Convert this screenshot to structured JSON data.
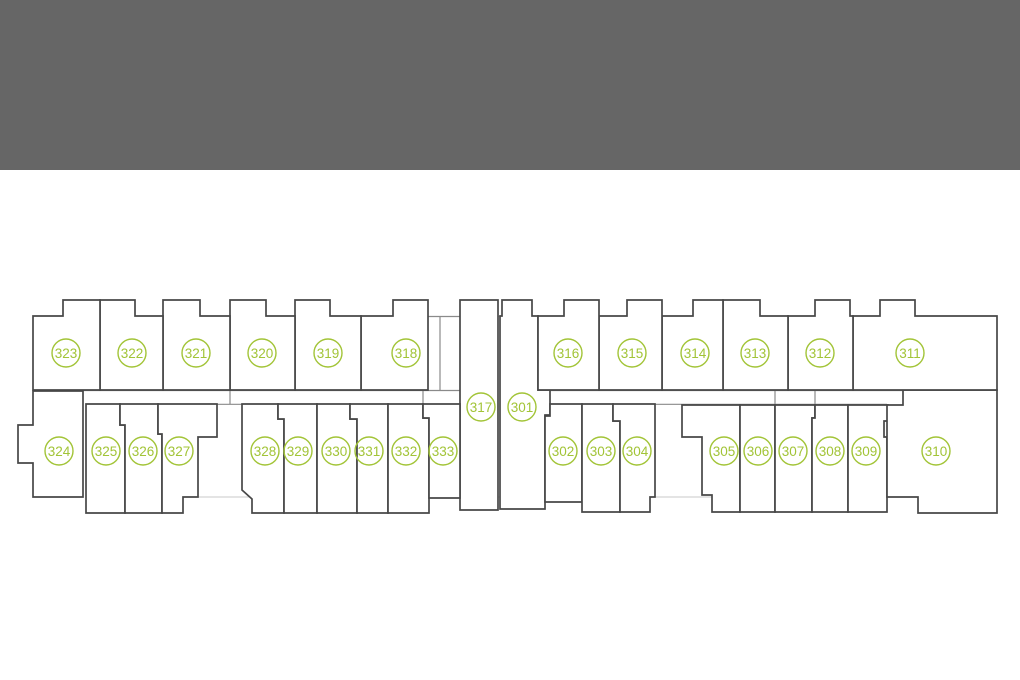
{
  "meta": {
    "description": "Apartment building floor plan with numbered units 301-333",
    "header_color": "#666666",
    "background_color": "#ffffff",
    "wall_color": "#474747",
    "light_line_color": "#c9c9c9",
    "medium_line_color": "#8a8a8a",
    "unit_green": "#a2c437",
    "badge_radius": 14
  },
  "units": [
    {
      "number": "301",
      "cx": 522,
      "cy": 407,
      "points": "502,300 532,300 532,316 538,316 538,390 550,390 550,415 545,415 545,509 500,509 500,316 502,316"
    },
    {
      "number": "302",
      "cx": 563,
      "cy": 451,
      "points": "550,404 582,404 582,502 545,502 545,416 550,416"
    },
    {
      "number": "303",
      "cx": 601,
      "cy": 451,
      "points": "582,404 613,404 613,421 620,421 620,512 582,512"
    },
    {
      "number": "304",
      "cx": 637,
      "cy": 451,
      "points": "613,404 655,404 655,497 650,497 650,512 620,512 620,421 613,421"
    },
    {
      "number": "305",
      "cx": 724,
      "cy": 451,
      "points": "682,405 740,405 740,512 712,512 712,495 702,495 702,437 682,437"
    },
    {
      "number": "306",
      "cx": 758,
      "cy": 451,
      "points": "740,405 775,405 775,512 740,512"
    },
    {
      "number": "307",
      "cx": 793,
      "cy": 451,
      "points": "775,405 815,405 815,418 812,418 812,512 775,512"
    },
    {
      "number": "308",
      "cx": 830,
      "cy": 451,
      "points": "815,405 848,405 848,512 812,512 812,418 815,418"
    },
    {
      "number": "309",
      "cx": 866,
      "cy": 451,
      "points": "848,405 888,405 888,421 884,421 884,437 887,437 887,512 848,512"
    },
    {
      "number": "310",
      "cx": 936,
      "cy": 451,
      "points": "887,405 903,405 903,390 997,390 997,513 918,513 918,497 887,497"
    },
    {
      "number": "311",
      "cx": 910,
      "cy": 353,
      "points": "853,316 880,316 880,300 915,300 915,316 997,316 997,390 853,390"
    },
    {
      "number": "312",
      "cx": 820,
      "cy": 353,
      "points": "788,316 815,316 815,300 850,300 850,316 853,316 853,390 788,390"
    },
    {
      "number": "313",
      "cx": 755,
      "cy": 353,
      "points": "723,300 760,300 760,316 788,316 788,390 723,390"
    },
    {
      "number": "314",
      "cx": 695,
      "cy": 353,
      "points": "662,316 693,316 693,300 723,300 723,390 662,390"
    },
    {
      "number": "315",
      "cx": 632,
      "cy": 353,
      "points": "599,316 627,316 627,300 662,300 662,390 599,390"
    },
    {
      "number": "316",
      "cx": 568,
      "cy": 353,
      "points": "538,316 564,316 564,300 599,300 599,390 538,390"
    },
    {
      "number": "317",
      "cx": 481,
      "cy": 407,
      "points": "460,300 498,300 498,510 460,510"
    },
    {
      "number": "318",
      "cx": 406,
      "cy": 353,
      "points": "361,316 393,316 393,300 428,300 428,390 361,390"
    },
    {
      "number": "319",
      "cx": 328,
      "cy": 353,
      "points": "295,300 330,300 330,316 361,316 361,390 295,390"
    },
    {
      "number": "320",
      "cx": 262,
      "cy": 353,
      "points": "230,300 266,300 266,316 295,316 295,390 230,390"
    },
    {
      "number": "321",
      "cx": 196,
      "cy": 353,
      "points": "163,300 200,300 200,316 230,316 230,390 163,390"
    },
    {
      "number": "322",
      "cx": 132,
      "cy": 353,
      "points": "100,300 135,300 135,316 163,316 163,390 100,390"
    },
    {
      "number": "323",
      "cx": 66,
      "cy": 353,
      "points": "33,316 63,316 63,300 100,300 100,390 33,390"
    },
    {
      "number": "324",
      "cx": 59,
      "cy": 451,
      "points": "33,391 83,391 83,497 33,497 33,463 18,463 18,425 33,425"
    },
    {
      "number": "325",
      "cx": 106,
      "cy": 451,
      "points": "86,404 120,404 120,425 125,425 125,513 86,513"
    },
    {
      "number": "326",
      "cx": 143,
      "cy": 451,
      "points": "120,404 158,404 158,434 162,434 162,513 125,513 125,425 120,425"
    },
    {
      "number": "327",
      "cx": 179,
      "cy": 451,
      "points": "158,404 217,404 217,437 198,437 198,497 183,497 183,513 162,513 162,434 158,434"
    },
    {
      "number": "328",
      "cx": 265,
      "cy": 451,
      "points": "242,404 278,404 278,419 284,419 284,513 252,513 252,499 242,490"
    },
    {
      "number": "329",
      "cx": 298,
      "cy": 451,
      "points": "278,404 317,404 317,513 284,513 284,419 278,419"
    },
    {
      "number": "330",
      "cx": 336,
      "cy": 451,
      "points": "317,404 350,404 350,419 357,419 357,513 317,513"
    },
    {
      "number": "331",
      "cx": 369,
      "cy": 451,
      "points": "350,404 388,404 388,513 357,513 357,419 350,419"
    },
    {
      "number": "332",
      "cx": 406,
      "cy": 451,
      "points": "388,404 423,404 423,418 429,418 429,513 388,513"
    },
    {
      "number": "333",
      "cx": 443,
      "cy": 451,
      "points": "423,404 460,404 460,498 429,498 429,418 423,418"
    }
  ],
  "light_lines": [
    {
      "x1": 33,
      "y1": 316.5,
      "x2": 997,
      "y2": 316.5
    },
    {
      "x1": 86,
      "y1": 497,
      "x2": 997,
      "y2": 497
    },
    {
      "x1": 979,
      "y1": 318,
      "x2": 979,
      "y2": 497
    },
    {
      "x1": 33,
      "y1": 425,
      "x2": 33,
      "y2": 463
    }
  ],
  "medium_lines": [
    {
      "x1": 33,
      "y1": 390.5,
      "x2": 460,
      "y2": 390.5
    },
    {
      "x1": 538,
      "y1": 390.5,
      "x2": 903,
      "y2": 390.5
    },
    {
      "x1": 86,
      "y1": 404.3,
      "x2": 460,
      "y2": 404.3
    },
    {
      "x1": 550,
      "y1": 404.3,
      "x2": 887,
      "y2": 404.3
    },
    {
      "x1": 428,
      "y1": 316.5,
      "x2": 460,
      "y2": 316.5
    },
    {
      "x1": 440,
      "y1": 316,
      "x2": 440,
      "y2": 390
    },
    {
      "x1": 230,
      "y1": 390,
      "x2": 230,
      "y2": 404
    },
    {
      "x1": 423,
      "y1": 390,
      "x2": 423,
      "y2": 404
    },
    {
      "x1": 775,
      "y1": 390,
      "x2": 775,
      "y2": 405
    },
    {
      "x1": 815,
      "y1": 390,
      "x2": 815,
      "y2": 405
    }
  ]
}
